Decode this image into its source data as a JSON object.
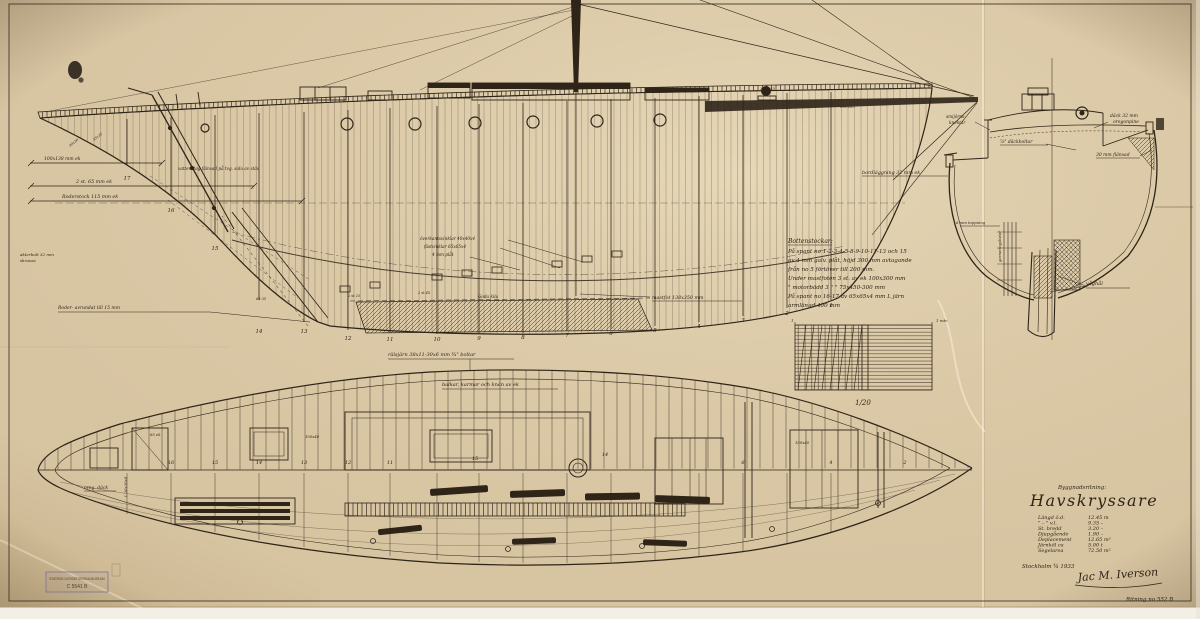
{
  "document": {
    "type_label": "Byggnadsritning:",
    "title": "Havskryssare",
    "specs": [
      {
        "label": "Längd ö.d.",
        "value": "12.45 m"
      },
      {
        "label": "\" – \"  v.l.",
        "value": "9.35 –"
      },
      {
        "label": "St. bredd",
        "value": "3.20 –"
      },
      {
        "label": "Djupgående",
        "value": "1.90 –"
      },
      {
        "label": "Deplacement",
        "value": "12.65 m³"
      },
      {
        "label": "Järnköl   ca",
        "value": "5.00 t"
      },
      {
        "label": "Segelarea",
        "value": "72.50 m²"
      }
    ],
    "place_date": "Stockholm ¾ 1933",
    "signature": "Jac M. Iverson",
    "drawing_no": "Ritning no 552 B"
  },
  "profile": {
    "labels": [
      "100x138 mm ek",
      "2 st. 65 mm ek",
      "Roderstock 115 mm ek",
      "Roder- avrundat till 15 mm",
      "vattenstag flänsad på tvg. sida av stäv",
      "överkantsvinklar 40x40x4",
      "fästvinklar 65x65x4",
      "4 mm plåt",
      "bordläggning 32 mm ek",
      "mastfot 138x350 mm",
      "300x55",
      "260x55",
      "Goda kila",
      "2 st 25",
      "2 st 45",
      "68 35",
      "akterbult 32 mm",
      "skruvas",
      "30x30",
      "35x35"
    ],
    "frame_numbers": [
      "17",
      "16",
      "15",
      "14",
      "13",
      "12",
      "11",
      "10",
      "9",
      "8",
      "7",
      "6",
      "5",
      "4",
      "3",
      "2",
      "1"
    ]
  },
  "section": {
    "labels": [
      "smijörns-",
      "knektar",
      "⅞\" däckboltar",
      "däck 32 mm",
      "oregonpine",
      "30 mm flänsad",
      "6 mm toppning",
      "garneringslister",
      "våghål"
    ]
  },
  "notes": {
    "heading": "Bottenstockar:",
    "lines": [
      "På spant no 1-2-3-4-5-8-9-10-11-13 och 15",
      "av 4 mm galv. plåt, höjd 300 mm avtagande",
      "från no 5 förtöver till 200 mm.",
      "Under mastfoten 3 st. av ek 100x300 mm",
      "  \"  motorbädd 3  \"   \"  75x450-300 mm",
      "På spant no 16-17 av 65x65x4 mm L järn",
      "armlängd 400 mm"
    ]
  },
  "scale": {
    "ratio": "1/20",
    "unit": "1 mtr.",
    "left_tick": "1"
  },
  "plan": {
    "labels": [
      "rälsjärn 38x11-30x6 mm  ¾\" boltar",
      "balkar, karmar och knän av ek",
      "oreg. däck",
      "65 ek",
      "100x40",
      "100x40",
      "L 30x30x4"
    ],
    "frame_numbers": [
      "17",
      "16",
      "15",
      "14",
      "13",
      "12",
      "11",
      "10",
      "9",
      "8",
      "7",
      "6",
      "5",
      "4",
      "3",
      "2",
      "1"
    ]
  },
  "stamp": {
    "line1": "STATENS SJÖHISTORISKA MUSEUM",
    "line2": "C 5541 B"
  },
  "colors": {
    "paper": "#d8c5a2",
    "ink": "#2e2418",
    "faint_ink": "#6e5d46",
    "stamp": "#7d6f96"
  }
}
